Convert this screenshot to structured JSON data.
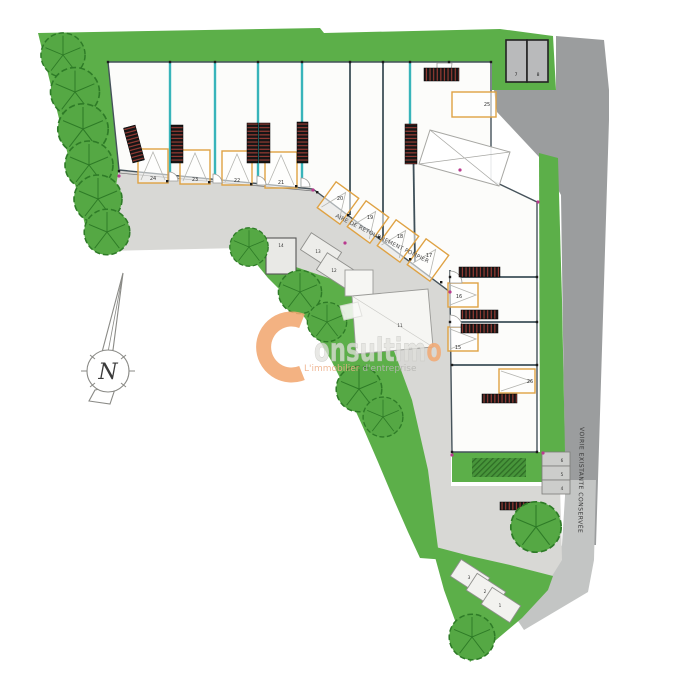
{
  "plan": {
    "labels": {
      "top_row": [
        "24",
        "23",
        "22",
        "21"
      ],
      "diagonal_row": [
        "20",
        "19",
        "18",
        "17"
      ],
      "right_column": [
        "16",
        "15"
      ],
      "upper_right_unit": "25",
      "large_unit": "26",
      "small_box": "14",
      "mid_cells": [
        "13",
        "12"
      ],
      "center_structure": "11",
      "garage_boxes": [
        "7",
        "8"
      ],
      "right_cells": [
        "6",
        "5",
        "4"
      ],
      "bottom_cells": [
        "3",
        "2",
        "1"
      ]
    },
    "annotations": {
      "fire_lane": "AIRE DE RETOURNEMENT POMPIER",
      "existing_road": "VOIRIE EXISTANTE CONSERVÉE",
      "compass_north": "N"
    },
    "watermark": {
      "brand": "Consultimo",
      "rest": "onsultim",
      "last_letter": "o",
      "tagline_left": "L'immobilier ",
      "tagline_right": "d'entreprise"
    },
    "colors": {
      "site_green": "#5caf49",
      "tree_green": "#55a844",
      "hedge_green": "#47953a",
      "road_light": "#d8d8d5",
      "road_dark": "#9b9d9e",
      "road_medium": "#c3c5c4",
      "partition_teal": "#38b4ba",
      "door_orange": "#dfa243",
      "wall_dark": "#3f5059",
      "brand_orange": "#f2a871"
    }
  }
}
